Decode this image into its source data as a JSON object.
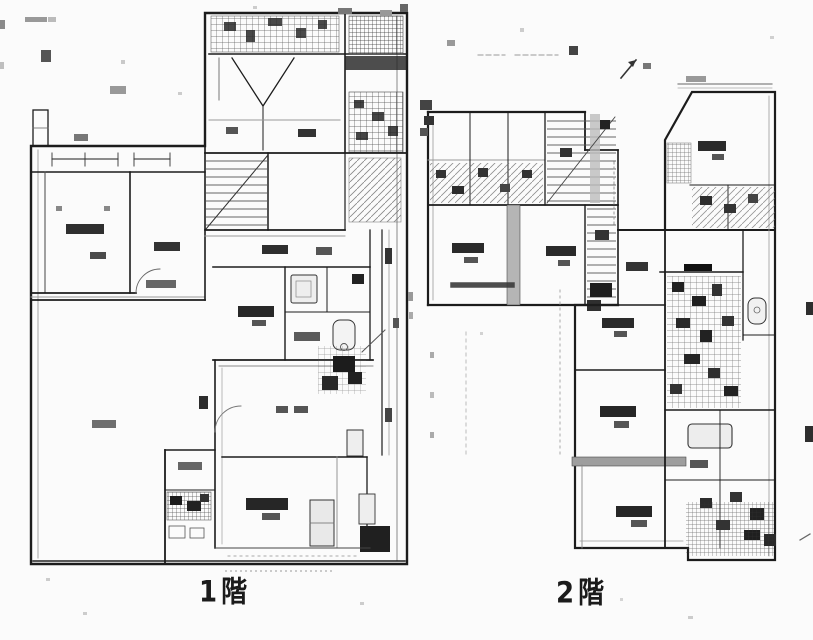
{
  "page": {
    "background": "#fbfbfb",
    "ink": "#1b1b1b",
    "secondary_gray": "#8a8a8a",
    "description_of_image": "scanned two-storey Japanese house floor plan"
  },
  "plans": [
    {
      "id": "floor-1",
      "label": "1階"
    },
    {
      "id": "floor-2",
      "label": "2階"
    }
  ]
}
